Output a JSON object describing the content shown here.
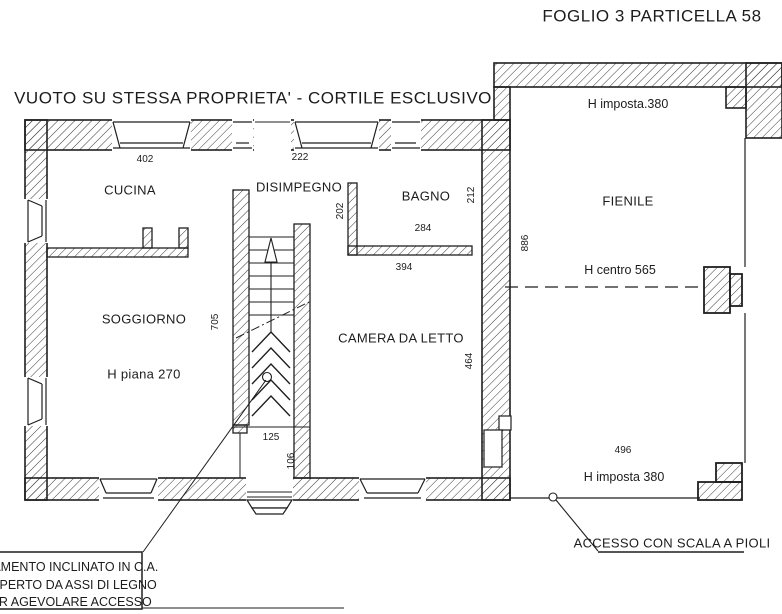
{
  "title": {
    "sheet": "FOGLIO 3 PARTICELLA 58"
  },
  "plan": {
    "courtyard_label": "VUOTO SU STESSA PROPRIETA' - CORTILE ESCLUSIVO",
    "rooms": {
      "cucina": "CUCINA",
      "disimpegno": "DISIMPEGNO",
      "bagno": "BAGNO",
      "soggiorno": "SOGGIORNO",
      "camera_da_letto": "CAMERA DA LETTO",
      "fienile": "FIENILE"
    },
    "dims": {
      "cucina_width": "402",
      "disimpegno_width": "222",
      "disimpegno_depth": "202",
      "bagno_width": "284",
      "bagno_depth": "212",
      "camera_width": "394",
      "camera_depth": "464",
      "soggiorno_depth": "705",
      "vestibule_width": "125",
      "vestibule_depth": "106",
      "fienile_depth": "886",
      "fienile_width": "496"
    },
    "heights": {
      "soggiorno_h": "H piana 270",
      "fienile_h_imposta_top": "H imposta.380",
      "fienile_h_centro": "H centro 565",
      "fienile_h_imposta_bottom": "H imposta 380"
    },
    "annotations": {
      "access_label": "ACCESSO CON SCALA A PIOLI",
      "note_line1": "ASAMENTO INCLINATO IN C.A.",
      "note_line2": "ICOPERTO DA ASSI DI LEGNO",
      "note_line3": "PER AGEVOLARE ACCESSO"
    }
  },
  "colors": {
    "ink": "#1c1c1c",
    "paper": "#ffffff"
  }
}
